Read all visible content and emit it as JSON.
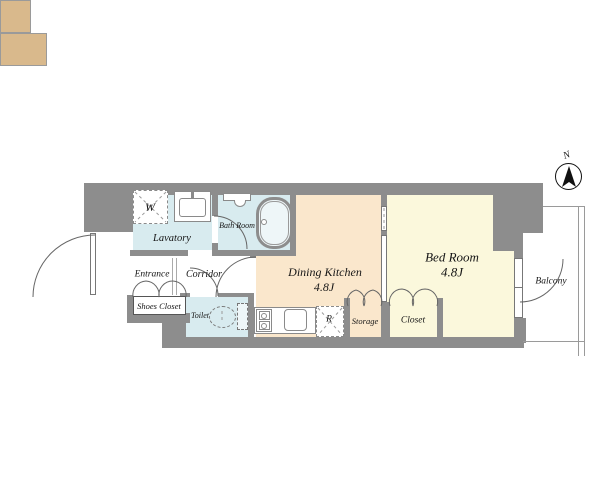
{
  "colors": {
    "wall": "#8d8d8d",
    "wet-floor": "#d8ebef",
    "kitchen-floor": "#fae7cc",
    "bedroom-floor": "#fbf8dc",
    "closet-floor": "#d9b98c"
  },
  "compass": {
    "north_label": "N"
  },
  "rooms": {
    "lavatory": {
      "label": "Lavatory"
    },
    "washer_space": {
      "label": "W"
    },
    "bath_room": {
      "label": "Bath Room"
    },
    "entrance": {
      "label": "Entrance"
    },
    "corridor": {
      "label": "Corridor"
    },
    "shoes_closet": {
      "label": "Shoes Closet"
    },
    "toilet": {
      "label": "Toilet"
    },
    "dining_kitchen": {
      "label": "Dining Kitchen",
      "size": "4.8J"
    },
    "bed_room": {
      "label": "Bed Room",
      "size": "4.8J"
    },
    "storage": {
      "label": "Storage"
    },
    "closet": {
      "label": "Closet"
    },
    "balcony": {
      "label": "Balcony"
    },
    "refrigerator_space": {
      "label": "R"
    }
  }
}
